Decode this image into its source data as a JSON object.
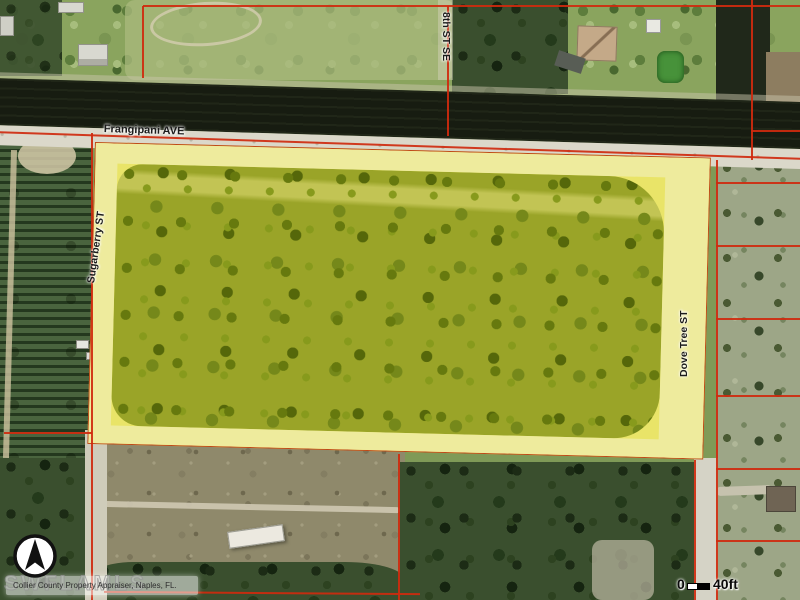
{
  "map": {
    "streets": {
      "frangipani": "Frangipani AVE",
      "eighth": "8th ST SE",
      "sugarberry": "Sugarberry ST",
      "dove_tree": "Dove Tree ST"
    },
    "attribution": "Collier County Property Appraiser, Naples, FL.",
    "watermark": "SWFLAMLS",
    "scale": {
      "zero_label": "0",
      "distance_label": "40ft"
    },
    "colors": {
      "highlight_yellow": "#e9e468",
      "highlight_pale_road": "#eeeb9d",
      "boundary_red": "#cf2a0e",
      "canal_water": "#171c11",
      "road_gray": "#dbd8ca"
    }
  }
}
